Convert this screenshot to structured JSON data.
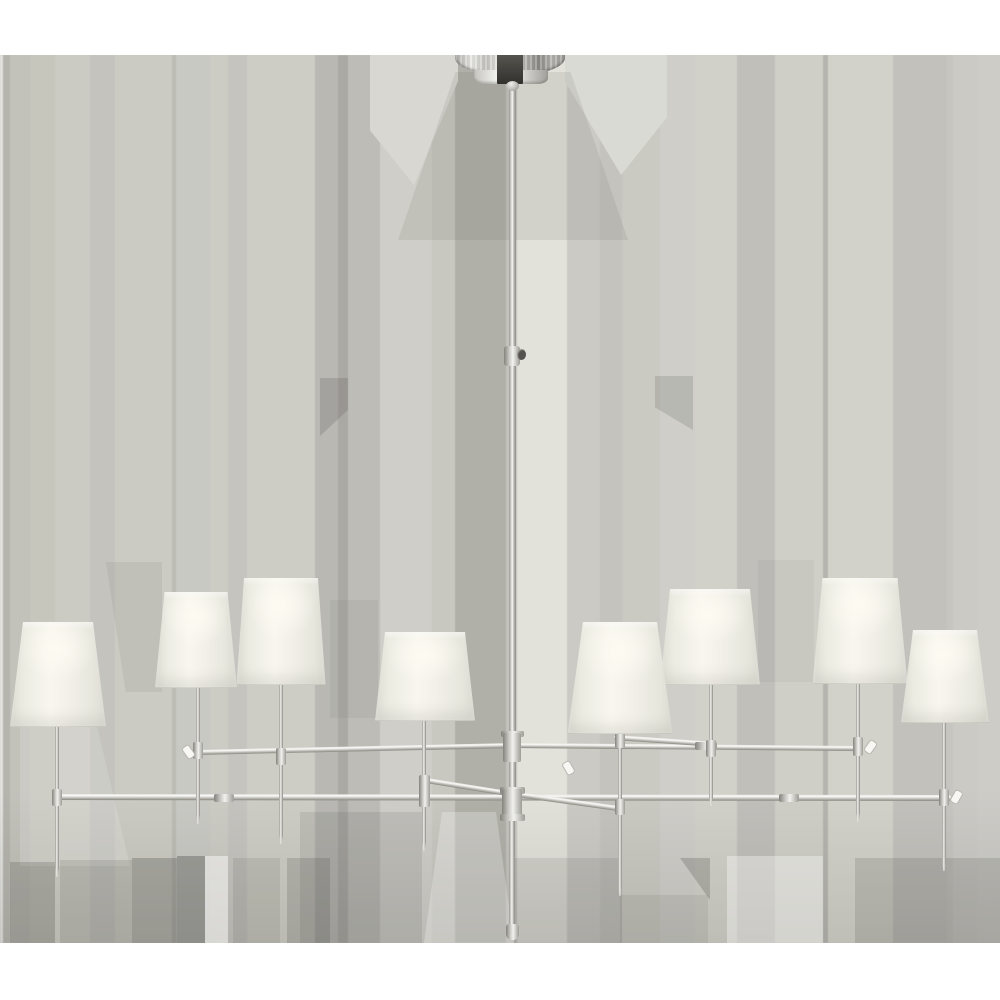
{
  "image": {
    "subject": "Product photo: large two-tier eight-light chandelier with tapered off-white linen shades and a polished nickel frame, hung from a dome canopy on a pale striped gray backdrop",
    "width": 1000,
    "height": 1000
  },
  "background": {
    "base_color": "#c9c8c1",
    "top_band": {
      "color": "#ffffff",
      "y": 0,
      "height": 55
    },
    "bottom_band": {
      "color": "#ffffff",
      "y": 943,
      "height": 57
    },
    "stripes_y": 55,
    "stripes_height": 888,
    "bottom_shade": {
      "y": 790,
      "height": 153,
      "gradient": "linear-gradient(180deg, rgba(58,57,53,0) 0%, rgba(58,57,53,0.13) 100%)"
    },
    "stripes": [
      {
        "x": 0,
        "w": 3,
        "c": "#e3e3e1"
      },
      {
        "x": 3,
        "w": 7,
        "c": "#b5b4ad"
      },
      {
        "x": 10,
        "w": 20,
        "c": "#c2c1ba"
      },
      {
        "x": 30,
        "w": 25,
        "c": "#c7c6bd"
      },
      {
        "x": 55,
        "w": 35,
        "c": "#cccbc3"
      },
      {
        "x": 90,
        "w": 25,
        "c": "#c4c3be"
      },
      {
        "x": 115,
        "w": 57,
        "c": "#cbcbc3"
      },
      {
        "x": 172,
        "w": 4,
        "c": "#bcbbb4"
      },
      {
        "x": 176,
        "w": 34,
        "c": "#c9c9c4"
      },
      {
        "x": 210,
        "w": 18,
        "c": "#cccbc4"
      },
      {
        "x": 228,
        "w": 19,
        "c": "#c5c4bf"
      },
      {
        "x": 247,
        "w": 68,
        "c": "#cecdc5"
      },
      {
        "x": 315,
        "w": 23,
        "c": "#b9b8b3"
      },
      {
        "x": 338,
        "w": 10,
        "c": "#aba9a4"
      },
      {
        "x": 348,
        "w": 32,
        "c": "#bdbcb6"
      },
      {
        "x": 380,
        "w": 52,
        "c": "#cfcec8"
      },
      {
        "x": 432,
        "w": 23,
        "c": "#c8c7c0"
      },
      {
        "x": 455,
        "w": 51,
        "c": "#b0afa8"
      },
      {
        "x": 506,
        "w": 11,
        "c": "#c4c3bd"
      },
      {
        "x": 517,
        "w": 50,
        "c": "#e2e1da"
      },
      {
        "x": 567,
        "w": 33,
        "c": "#cbcac4"
      },
      {
        "x": 600,
        "w": 22,
        "c": "#c4c3bd"
      },
      {
        "x": 622,
        "w": 38,
        "c": "#cac9c2"
      },
      {
        "x": 660,
        "w": 35,
        "c": "#cfcec9"
      },
      {
        "x": 695,
        "w": 42,
        "c": "#d2d1c9"
      },
      {
        "x": 737,
        "w": 38,
        "c": "#c1bfba"
      },
      {
        "x": 775,
        "w": 48,
        "c": "#d0cfc7"
      },
      {
        "x": 823,
        "w": 5,
        "c": "#b5b4ae"
      },
      {
        "x": 828,
        "w": 65,
        "c": "#d3d2ca"
      },
      {
        "x": 893,
        "w": 54,
        "c": "#c3c1bc"
      },
      {
        "x": 947,
        "w": 6,
        "c": "#c6c5c0"
      },
      {
        "x": 953,
        "w": 24,
        "c": "#cbcac5"
      },
      {
        "x": 977,
        "w": 23,
        "c": "#cdccc7"
      }
    ],
    "patches": [
      {
        "x": 370,
        "y": 55,
        "w": 88,
        "h": 130,
        "c": "#d8d7d2",
        "clip": "polygon(0 0,100% 0,100% 20%,50% 100%,0 58%)"
      },
      {
        "x": 565,
        "y": 55,
        "w": 102,
        "h": 120,
        "c": "#dadad5",
        "clip": "polygon(0 0,100% 0,100% 52%,55% 100%,0 22%)"
      },
      {
        "x": 398,
        "y": 72,
        "w": 230,
        "h": 168,
        "c": "rgba(100,98,92,0.12)",
        "clip": "polygon(25% 0,75% 0,100% 100%,0 100%)"
      },
      {
        "x": 320,
        "y": 378,
        "w": 28,
        "h": 58,
        "c": "rgba(70,69,65,0.18)",
        "clip": "polygon(0 0,100% 0,100% 55%,0 100%)"
      },
      {
        "x": 655,
        "y": 376,
        "w": 38,
        "h": 54,
        "c": "rgba(70,69,65,0.16)",
        "clip": "polygon(0 0,100% 0,100% 100%,0 58%)"
      },
      {
        "x": 106,
        "y": 562,
        "w": 56,
        "h": 130,
        "c": "rgba(90,89,84,0.09)",
        "clip": "polygon(0 0,100% 0,100% 100%,35% 100%)"
      },
      {
        "x": 330,
        "y": 600,
        "w": 48,
        "h": 118,
        "c": "rgba(90,89,84,0.07)"
      },
      {
        "x": 758,
        "y": 560,
        "w": 56,
        "h": 122,
        "c": "rgba(90,89,84,0.06)"
      },
      {
        "x": 20,
        "y": 726,
        "w": 110,
        "h": 140,
        "c": "rgba(255,255,255,0.15)",
        "clip": "polygon(0 0,70% 0,100% 100%,0 100%)"
      },
      {
        "x": 10,
        "y": 862,
        "w": 45,
        "h": 81,
        "c": "rgba(62,61,57,0.20)"
      },
      {
        "x": 60,
        "y": 860,
        "w": 72,
        "h": 83,
        "c": "rgba(62,61,57,0.13)"
      },
      {
        "x": 132,
        "y": 858,
        "w": 45,
        "h": 85,
        "c": "rgba(62,61,57,0.26)"
      },
      {
        "x": 177,
        "y": 856,
        "w": 28,
        "h": 87,
        "c": "rgba(50,49,46,0.30)"
      },
      {
        "x": 205,
        "y": 856,
        "w": 23,
        "h": 87,
        "c": "rgba(255,255,255,0.45)"
      },
      {
        "x": 233,
        "y": 858,
        "w": 47,
        "h": 85,
        "c": "rgba(62,61,57,0.11)"
      },
      {
        "x": 287,
        "y": 858,
        "w": 43,
        "h": 85,
        "c": "rgba(62,61,57,0.18)"
      },
      {
        "x": 300,
        "y": 812,
        "w": 122,
        "h": 131,
        "c": "rgba(75,74,70,0.12)"
      },
      {
        "x": 424,
        "y": 812,
        "w": 90,
        "h": 131,
        "c": "rgba(255,255,255,0.25)",
        "clip": "polygon(20% 0,80% 0,100% 100%,0 100%)"
      },
      {
        "x": 514,
        "y": 858,
        "w": 108,
        "h": 85,
        "c": "rgba(75,74,70,0.12)"
      },
      {
        "x": 620,
        "y": 895,
        "w": 88,
        "h": 48,
        "c": "rgba(75,74,70,0.10)"
      },
      {
        "x": 680,
        "y": 858,
        "w": 30,
        "h": 42,
        "c": "rgba(60,59,56,0.22)",
        "clip": "polygon(0 0,100% 0,100% 100%)"
      },
      {
        "x": 727,
        "y": 856,
        "w": 96,
        "h": 87,
        "c": "rgba(255,255,255,0.35)"
      },
      {
        "x": 855,
        "y": 858,
        "w": 145,
        "h": 85,
        "c": "rgba(60,59,56,0.15)"
      }
    ]
  },
  "palette": {
    "arm_gradient": "linear-gradient(180deg,#e9e9e6 0%,#f8f8f6 28%,#c3c2bc 62%,#87867f 100%)",
    "stem_gradient": "linear-gradient(90deg,#98978f 0%,#d9d8d3 32%,#f6f6f4 50%,#b9b8b2 70%,#8e8d87 100%)",
    "collar_gradient": "linear-gradient(90deg,#83827c 0%,#cfcec9 35%,#f1f1ee 55%,#9d9c96 100%)",
    "dome_gradient": "linear-gradient(90deg,#aeada8 0%,#e8e8e5 15%,#c5c4bf 28%,#f4f4f1 46%,#c0bfba 60%,#8b8a85 76%,#b4b3ae 88%,#9d9c97 100%)",
    "neck_gradient": "linear-gradient(90deg,#c6c5c0 0%,#f3f3f0 32%,#ffffff 50%,#d5d4cf 68%,#a19f9a 100%)",
    "shade_gradient": "linear-gradient(90deg,#e2e1d8 0%,#edece3 15%,#f8f6ee 42%,#f2f0e8 60%,#e9e8df 82%,#e0dfd6 100%)",
    "shade_glow": "radial-gradient(55% 45% at 50% 26%, rgba(253,251,242,0.95), rgba(253,251,242,0) 70%)",
    "dark_block_gradient": "linear-gradient(180deg,#57554f 0%,#33312e 100%)",
    "ball_gradient": "radial-gradient(circle at 40% 30%, #f0efec, #8f8e88)",
    "knob_color": "#55534e",
    "peg_color": "#f8f7f3",
    "peg_border": "#b8b7b1"
  },
  "canopy": {
    "dome": {
      "x": 455,
      "y": 54,
      "w": 110,
      "h": 22
    },
    "neck": {
      "x": 474,
      "y": 70,
      "w": 74,
      "h": 14
    },
    "block": {
      "x": 497,
      "y": 54,
      "w": 26,
      "h": 30
    },
    "ball": {
      "cx": 512,
      "y": 81,
      "w": 13,
      "h": 10
    }
  },
  "rod": {
    "x": 512,
    "w": 7,
    "top": 86,
    "bottom": 790,
    "coupler": {
      "y": 346,
      "w": 16,
      "h": 20
    },
    "knob": {
      "x": 517,
      "y": 349,
      "w": 9,
      "h": 11
    },
    "lower": {
      "top": 820,
      "bottom": 928,
      "w": 6
    },
    "tip": {
      "y": 924,
      "w": 13,
      "h": 16
    }
  },
  "hub": {
    "upper_flange": {
      "cx": 512,
      "y": 731,
      "w": 23,
      "h": 6
    },
    "upper": {
      "cx": 512,
      "y": 733,
      "w": 18,
      "h": 29
    },
    "flange_top": {
      "cx": 512,
      "y": 787,
      "w": 25,
      "h": 7
    },
    "body": {
      "cx": 512,
      "y": 789,
      "w": 20,
      "h": 32
    },
    "flange_bottom": {
      "cx": 512,
      "y": 814,
      "w": 25,
      "h": 7
    }
  },
  "arms": [
    {
      "name": "upper-arm-left",
      "x1": 194,
      "y1": 752,
      "x2": 512,
      "y2": 745,
      "t": 5
    },
    {
      "name": "upper-arm-right",
      "x1": 512,
      "y1": 745,
      "x2": 860,
      "y2": 748,
      "t": 5
    },
    {
      "name": "upper-back-arm",
      "x1": 614,
      "y1": 737,
      "x2": 717,
      "y2": 744,
      "t": 4.5
    },
    {
      "name": "lower-arm",
      "x1": 53,
      "y1": 797,
      "x2": 951,
      "y2": 798,
      "t": 5.5
    },
    {
      "name": "lower-front-arm-left",
      "x1": 420,
      "y1": 779,
      "x2": 514,
      "y2": 794,
      "t": 5
    },
    {
      "name": "lower-front-arm-right",
      "x1": 510,
      "y1": 793,
      "x2": 618,
      "y2": 808,
      "t": 5
    }
  ],
  "arm_couplers": [
    {
      "cx": 224,
      "cy": 798,
      "w": 20,
      "h": 8
    },
    {
      "cx": 789,
      "cy": 798,
      "w": 20,
      "h": 8
    },
    {
      "cx": 706,
      "cy": 746,
      "w": 22,
      "h": 8
    }
  ],
  "stem_width": 4,
  "stems": [
    {
      "id": 1,
      "x": 57,
      "top": 726,
      "bottom": 877
    },
    {
      "id": 2,
      "x": 198,
      "top": 687,
      "bottom": 824
    },
    {
      "id": 3,
      "x": 281,
      "top": 684,
      "bottom": 844
    },
    {
      "id": 4,
      "x": 424,
      "top": 720,
      "bottom": 851
    },
    {
      "id": 5,
      "x": 620,
      "top": 733,
      "bottom": 896
    },
    {
      "id": 6,
      "x": 711,
      "top": 684,
      "bottom": 806
    },
    {
      "id": 7,
      "x": 858,
      "top": 683,
      "bottom": 822
    },
    {
      "id": 8,
      "x": 944,
      "top": 722,
      "bottom": 871
    }
  ],
  "socket_collars": [
    {
      "cx": 57,
      "y": 789,
      "w": 10,
      "h": 17
    },
    {
      "cx": 198,
      "y": 742,
      "w": 10,
      "h": 17
    },
    {
      "cx": 281,
      "y": 748,
      "w": 10,
      "h": 17
    },
    {
      "cx": 424,
      "y": 775,
      "w": 11,
      "h": 32
    },
    {
      "cx": 620,
      "y": 733,
      "w": 10,
      "h": 15
    },
    {
      "cx": 620,
      "y": 799,
      "w": 10,
      "h": 16
    },
    {
      "cx": 711,
      "y": 740,
      "w": 10,
      "h": 17
    },
    {
      "cx": 858,
      "y": 737,
      "w": 10,
      "h": 19
    },
    {
      "cx": 944,
      "y": 789,
      "w": 10,
      "h": 17
    }
  ],
  "switch_pegs": [
    {
      "cx": 187,
      "cy": 751,
      "rot": -35
    },
    {
      "cx": 869,
      "cy": 746,
      "rot": 35
    },
    {
      "cx": 955,
      "cy": 796,
      "rot": 30
    },
    {
      "cx": 567,
      "cy": 767,
      "rot": -30
    }
  ],
  "shades": [
    {
      "id": 2,
      "cx": 196,
      "top": 592,
      "top_w": 63,
      "bottom": 687,
      "bottom_w": 82
    },
    {
      "id": 3,
      "cx": 281,
      "top": 578,
      "top_w": 74,
      "bottom": 684,
      "bottom_w": 89
    },
    {
      "id": 1,
      "cx": 58,
      "top": 622,
      "top_w": 70,
      "bottom": 726,
      "bottom_w": 96
    },
    {
      "id": 4,
      "cx": 425,
      "top": 632,
      "top_w": 80,
      "bottom": 720,
      "bottom_w": 100
    },
    {
      "id": 6,
      "cx": 710,
      "top": 589,
      "top_w": 80,
      "bottom": 684,
      "bottom_w": 100
    },
    {
      "id": 7,
      "cx": 860,
      "top": 578,
      "top_w": 75,
      "bottom": 683,
      "bottom_w": 95
    },
    {
      "id": 8,
      "cx": 945,
      "top": 630,
      "top_w": 64,
      "bottom": 722,
      "bottom_w": 88
    },
    {
      "id": 5,
      "cx": 620,
      "top": 622,
      "top_w": 74,
      "bottom": 733,
      "bottom_w": 105
    }
  ]
}
